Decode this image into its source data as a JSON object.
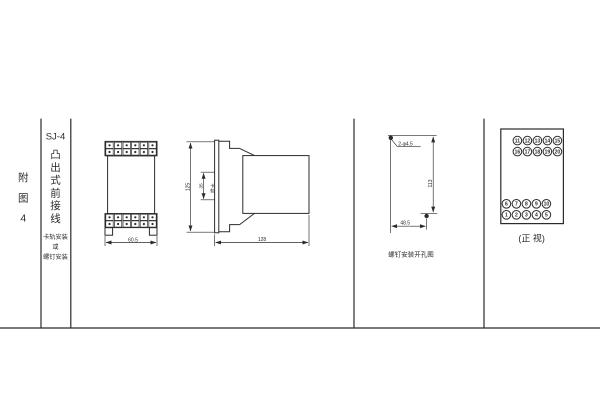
{
  "figure_label": {
    "chars": [
      "附",
      "图",
      "4"
    ]
  },
  "title_column": {
    "model": "SJ-4",
    "title_chars": [
      "凸",
      "出",
      "式",
      "前",
      "接",
      "线"
    ],
    "mounting_note_lines": [
      "卡轨安装",
      "或",
      "螺钉安装"
    ]
  },
  "front_view": {
    "width_dim": "60.5"
  },
  "side_view": {
    "height_dim": "125",
    "rail_dim": "35",
    "rail_label_chars": [
      "卡",
      "轨"
    ],
    "depth_dim": "128"
  },
  "screw_diagram": {
    "hole_label": "2-φ4.5",
    "vertical_dim": "113",
    "horizontal_dim": "48.5",
    "caption": "螺钉安装开孔图"
  },
  "terminal_view": {
    "top_row1": [
      "11",
      "12",
      "13",
      "14",
      "15"
    ],
    "top_row2": [
      "16",
      "17",
      "18",
      "19",
      "20"
    ],
    "bottom_row1": [
      "6",
      "7",
      "8",
      "9",
      "10"
    ],
    "bottom_row2": [
      "1",
      "2",
      "3",
      "4",
      "5"
    ],
    "caption": "(正 视)"
  },
  "colors": {
    "ink": "#2b2b2b",
    "background": "#ffffff"
  }
}
